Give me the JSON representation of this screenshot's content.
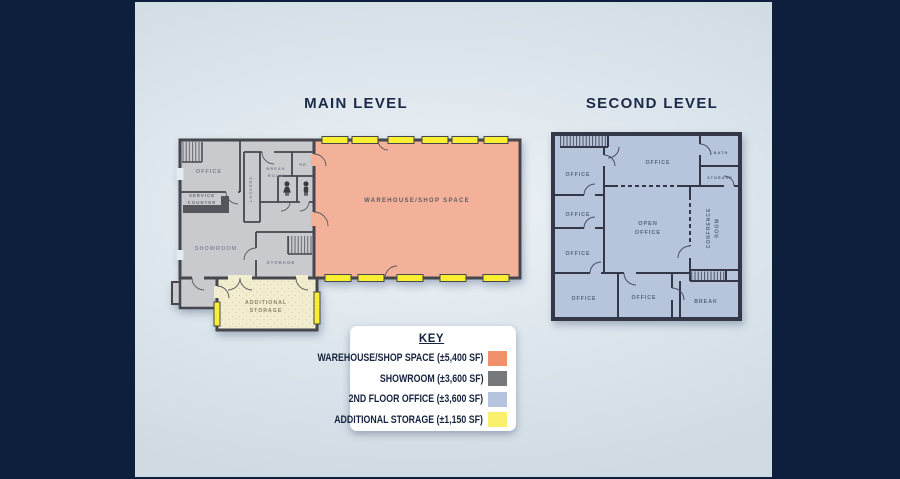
{
  "titles": {
    "main": "MAIN LEVEL",
    "second": "SECOND LEVEL"
  },
  "main_level": {
    "rooms": {
      "office": "OFFICE",
      "lockers": "LOCKERS",
      "break_line1": "BREAK",
      "break_line2": "ROOM",
      "rr": "RR",
      "service_line1": "SERVICE",
      "service_line2": "COUNTER",
      "showroom": "SHOWROOM",
      "storage": "STORAGE",
      "additional_line1": "ADDITIONAL",
      "additional_line2": "STORAGE",
      "warehouse": "WAREHOUSE/SHOP SPACE"
    }
  },
  "second_level": {
    "rooms": {
      "office": "OFFICE",
      "open_line1": "OPEN",
      "open_line2": "OFFICE",
      "bath": "BATH",
      "storage": "STORAGE",
      "conference_line1": "CONFRENCE",
      "conference_line2": "ROOM",
      "break": "BREAK"
    }
  },
  "key": {
    "title": "KEY",
    "items": [
      {
        "label": "WAREHOUSE/SHOP SPACE (±5,400 SF)",
        "color": "#F2906B"
      },
      {
        "label": "SHOWROOM (±3,600 SF)",
        "color": "#77787B"
      },
      {
        "label": "2ND FLOOR OFFICE (±3,600 SF)",
        "color": "#B5C4DE"
      },
      {
        "label": "ADDITIONAL STORAGE (±1,150 SF)",
        "color": "#FBF06D"
      }
    ]
  },
  "colors": {
    "sidebar_navy": "#0D1F3C",
    "warehouse_fill": "#F4B19A",
    "showroom_fill": "#C8CACD",
    "second_floor_fill": "#B7C5DC",
    "additional_storage_fill": "#F2EDCE",
    "overhead_door_yellow": "#F9EE32"
  }
}
